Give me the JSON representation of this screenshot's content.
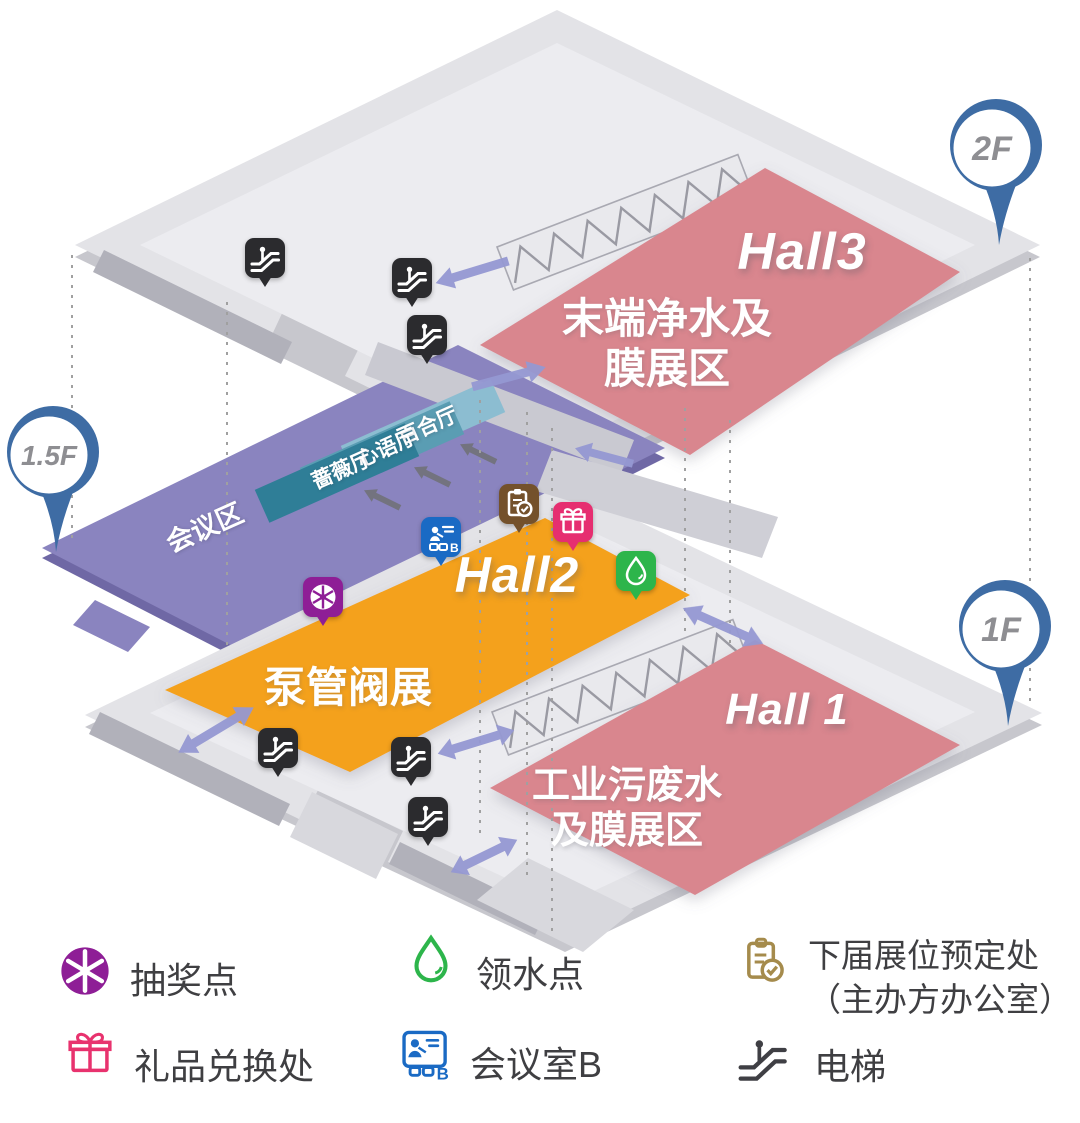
{
  "pins": {
    "f2": "2F",
    "f15": "1.5F",
    "f1": "1F"
  },
  "halls": {
    "hall3": {
      "title": "Hall3",
      "desc1": "末端净水及",
      "desc2": "膜展区"
    },
    "hall2": {
      "title": "Hall2",
      "desc": "泵管阀展"
    },
    "hall1": {
      "title": "Hall 1",
      "desc1": "工业污废水",
      "desc2": "及膜展区"
    }
  },
  "conference": {
    "area": "会议区",
    "rooms": [
      "百合厅",
      "心语厅",
      "蔷薇厅"
    ]
  },
  "meeting_icon_letter": "B",
  "legend": [
    {
      "icon": "lottery-wheel-icon",
      "label": "抽奖点"
    },
    {
      "icon": "water-drop-icon",
      "label": "领水点"
    },
    {
      "icon": "booth-booking-clipboard-icon",
      "label": "下届展位预定处",
      "label2": "（主办方办公室）"
    },
    {
      "icon": "gift-box-icon",
      "label": "礼品兑换处"
    },
    {
      "icon": "meeting-room-b-icon",
      "label": "会议室B"
    },
    {
      "icon": "escalator-icon",
      "label": "电梯"
    }
  ],
  "colors": {
    "hall_pink": "#D9868E",
    "hall_orange": "#F4A11B",
    "floor_purple": "#8A84BF",
    "floor_gray": "#E3E3E7",
    "pin_blue": "#3E6CA4",
    "arrow_purple": "#9598D2",
    "lottery_purple": "#8E1E96",
    "gift_pink": "#E62E70",
    "water_green": "#2DB54B",
    "booking_brown": "#74512B",
    "meeting_blue": "#1A6AC4",
    "escalator_black": "#2B2B2E"
  }
}
